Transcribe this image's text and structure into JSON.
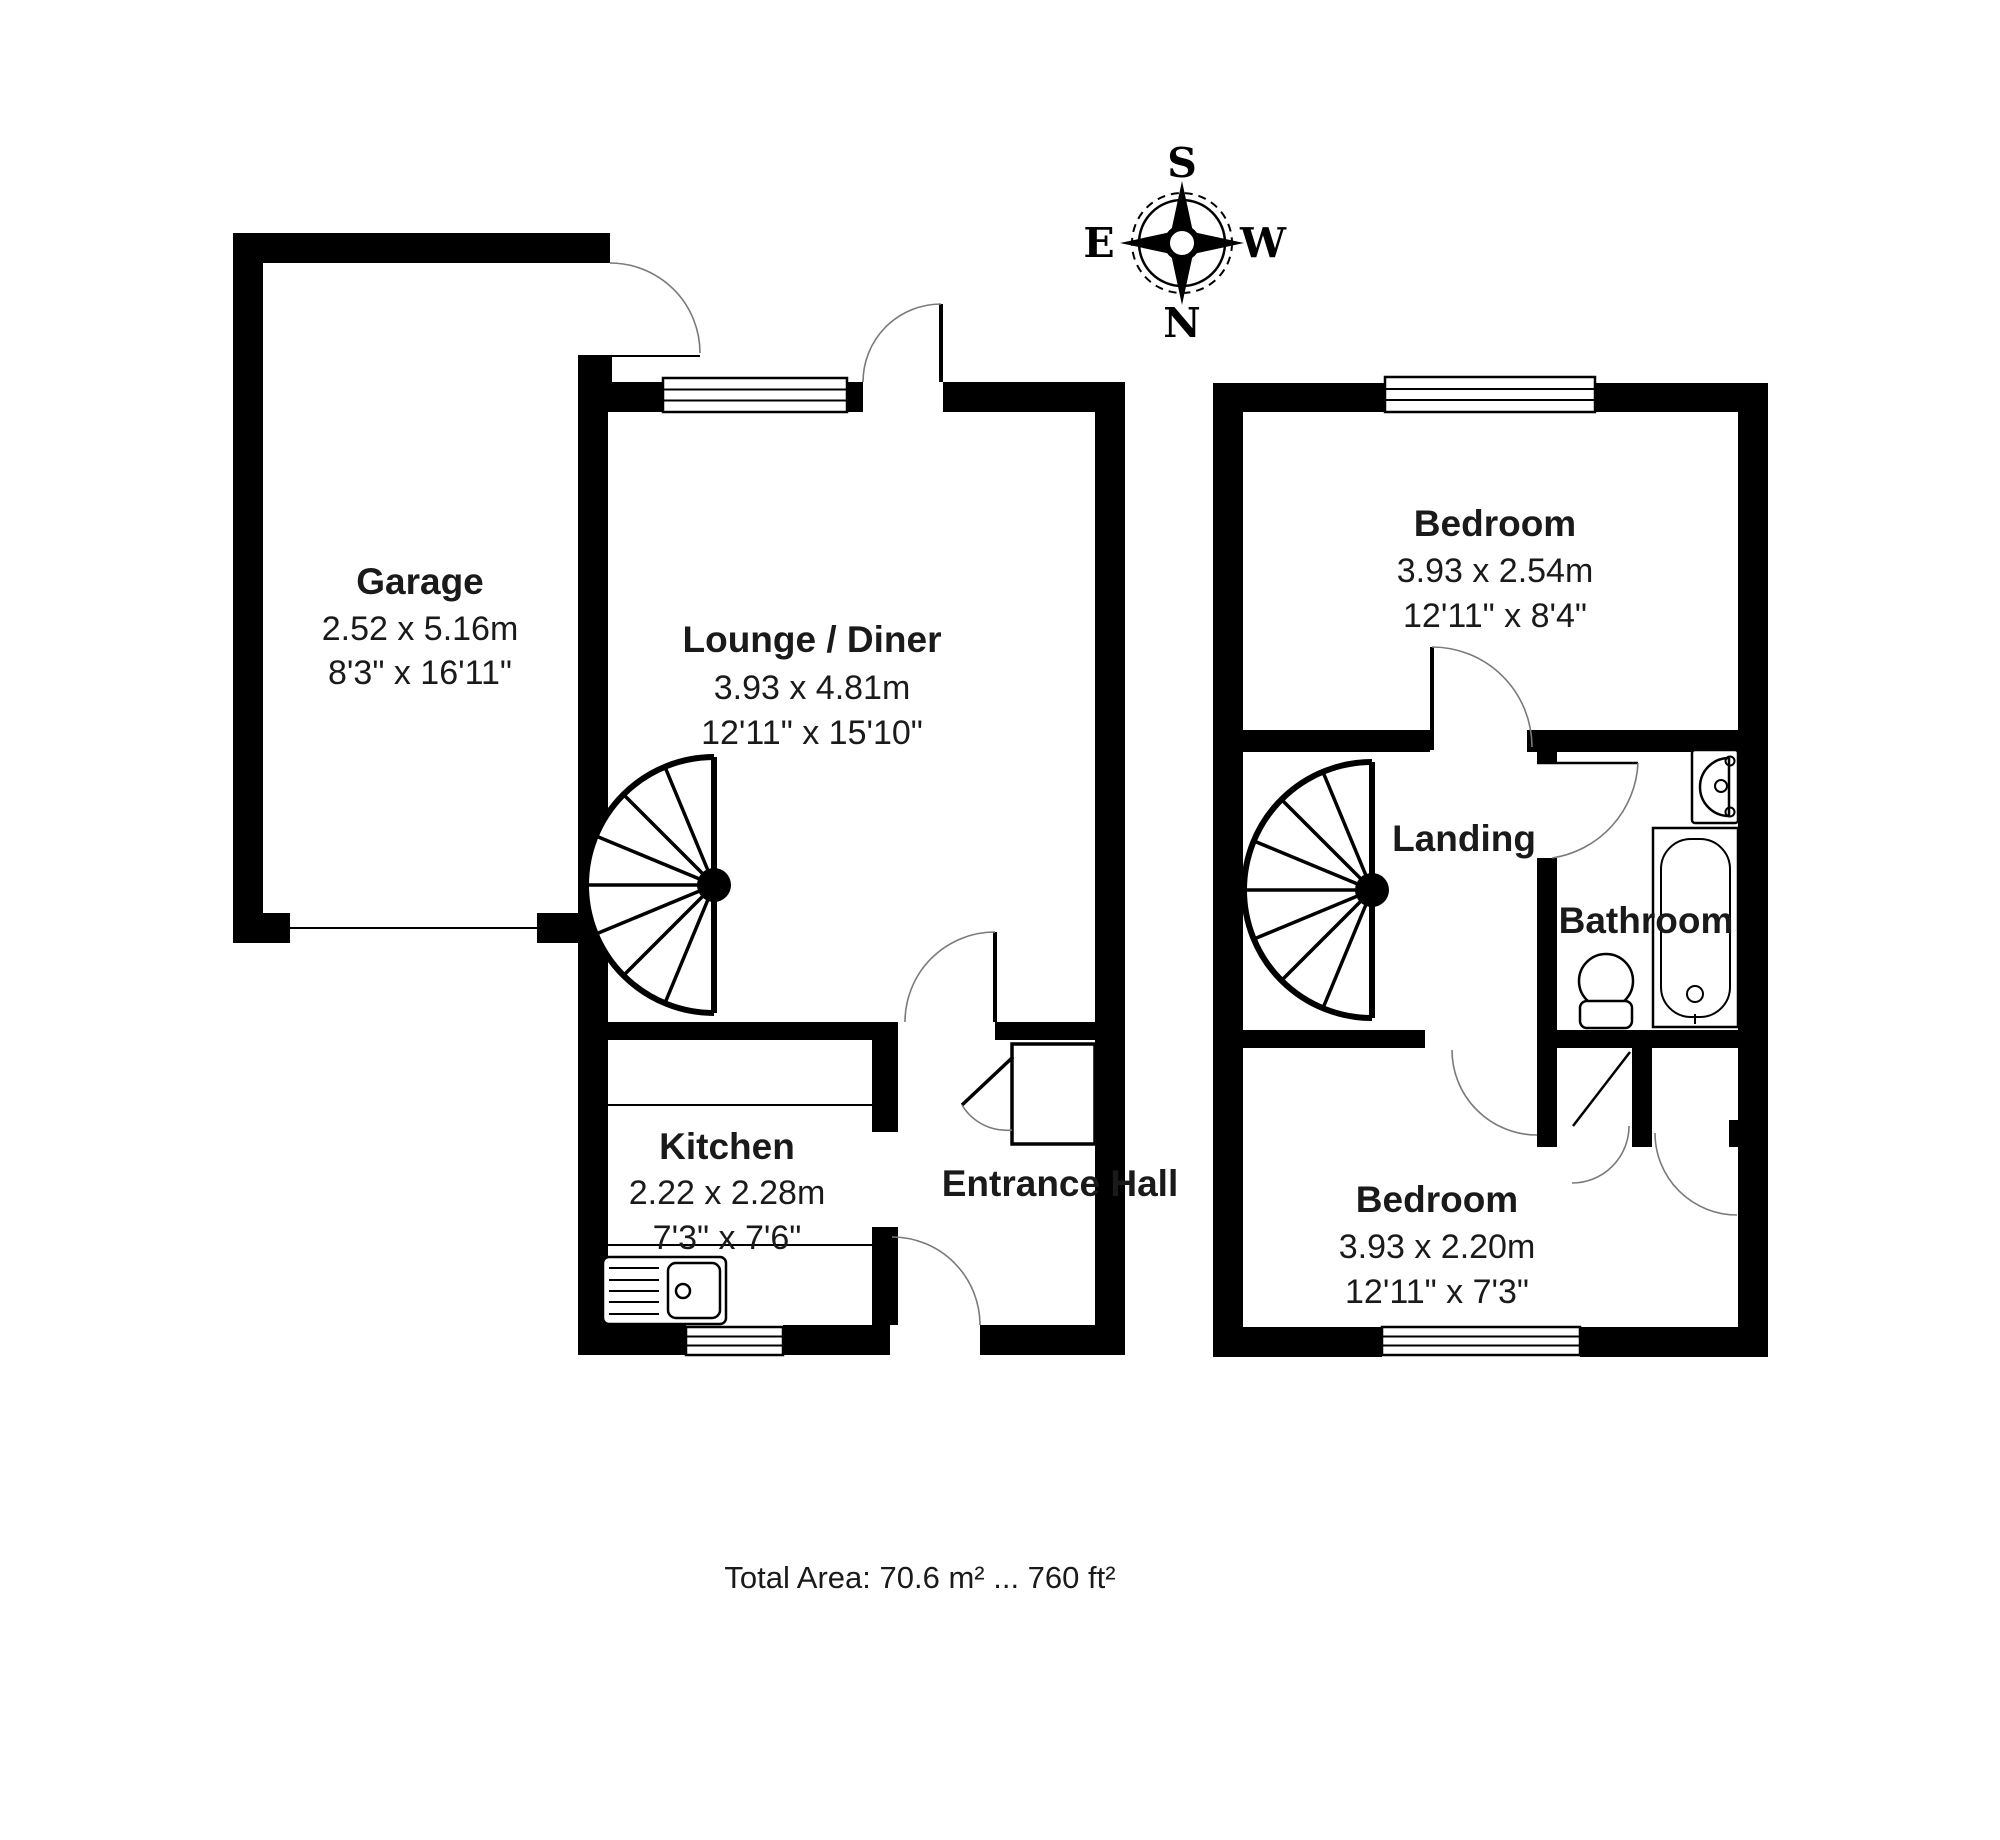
{
  "compass": {
    "south": "S",
    "east": "E",
    "west": "W",
    "north": "N"
  },
  "ground_floor": {
    "garage": {
      "name": "Garage",
      "metric": "2.52 x 5.16m",
      "imperial": "8'3\" x 16'11\""
    },
    "lounge": {
      "name": "Lounge / Diner",
      "metric": "3.93 x 4.81m",
      "imperial": "12'11\" x 15'10\""
    },
    "kitchen": {
      "name": "Kitchen",
      "metric": "2.22 x 2.28m",
      "imperial": "7'3\" x 7'6\""
    },
    "entrance_hall": {
      "name": "Entrance Hall"
    }
  },
  "first_floor": {
    "bedroom_front": {
      "name": "Bedroom",
      "metric": "3.93 x 2.54m",
      "imperial": "12'11\" x 8'4\""
    },
    "landing": {
      "name": "Landing"
    },
    "bathroom": {
      "name": "Bathroom"
    },
    "bedroom_back": {
      "name": "Bedroom",
      "metric": "3.93 x 2.20m",
      "imperial": "12'11\" x 7'3\""
    }
  },
  "footer": {
    "total_area": "Total Area: 70.6 m² ... 760 ft²"
  },
  "colors": {
    "wall": "#000000",
    "background": "#ffffff",
    "swing_arc": "#7a7a7a"
  }
}
